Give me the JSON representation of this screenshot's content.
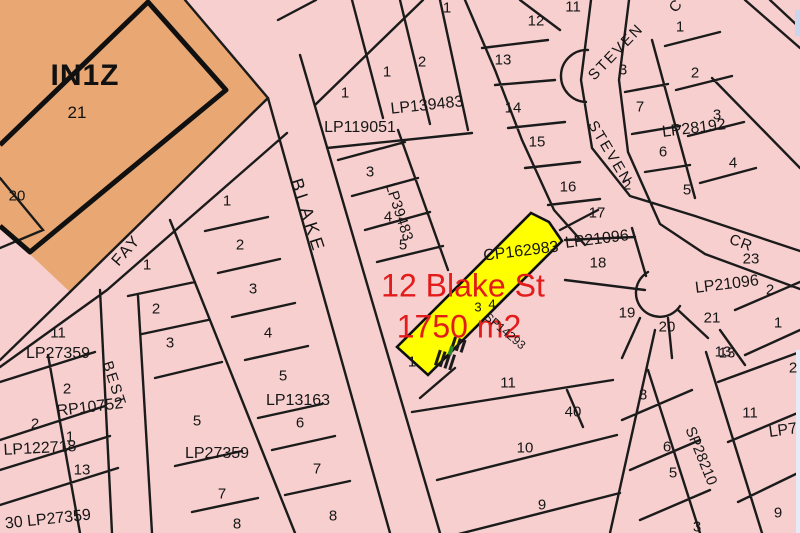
{
  "map": {
    "background": "#F7CFCF",
    "line_color": "#1b1b1b",
    "zone": {
      "code": "IN1Z",
      "lot_label": "21",
      "fill": "#E9A873"
    },
    "highlight_parcel": {
      "label_line1": "12 Blake St",
      "label_line2": "1750 m2",
      "fill": "#FFFF00",
      "label_color": "#e31b1b"
    },
    "street_labels": [
      {
        "t": "BLAKE",
        "x": 308,
        "y": 216,
        "r": 72,
        "s": 18,
        "ls": 4
      },
      {
        "t": "FAY",
        "x": 127,
        "y": 251,
        "r": -49,
        "s": 16,
        "ls": 2
      },
      {
        "t": "BEST",
        "x": 114,
        "y": 384,
        "r": 72,
        "s": 15,
        "ls": 2
      },
      {
        "t": "STEVEN",
        "x": 616,
        "y": 52,
        "r": -46,
        "s": 15,
        "ls": 2
      },
      {
        "t": "STEVEN",
        "x": 610,
        "y": 153,
        "r": 59,
        "s": 15,
        "ls": 2
      },
      {
        "t": "CR",
        "x": 741,
        "y": 243,
        "r": 20,
        "s": 15,
        "ls": 1
      },
      {
        "t": "C",
        "x": 676,
        "y": 6,
        "r": -50,
        "s": 15,
        "ls": 1
      }
    ],
    "plan_labels": [
      {
        "t": "LP119051",
        "x": 360,
        "y": 128,
        "r": 0
      },
      {
        "t": "LP139483",
        "x": 427,
        "y": 106,
        "r": -6
      },
      {
        "t": "LP39483",
        "x": 399,
        "y": 212,
        "r": 72,
        "s": 15
      },
      {
        "t": "LP28192",
        "x": 694,
        "y": 129,
        "r": -7
      },
      {
        "t": "CP162983",
        "x": 521,
        "y": 252,
        "r": -7
      },
      {
        "t": "LP21096",
        "x": 597,
        "y": 240,
        "r": -7
      },
      {
        "t": "LP21096",
        "x": 727,
        "y": 285,
        "r": -7
      },
      {
        "t": "LP27359",
        "x": 58,
        "y": 354,
        "r": 0
      },
      {
        "t": "RP10752",
        "x": 90,
        "y": 408,
        "r": -7
      },
      {
        "t": "LP122718",
        "x": 40,
        "y": 449,
        "r": -3
      },
      {
        "t": "LP13163",
        "x": 298,
        "y": 401,
        "r": 0
      },
      {
        "t": "LP27359",
        "x": 217,
        "y": 454,
        "r": 0
      },
      {
        "t": "30 LP27359",
        "x": 48,
        "y": 520,
        "r": -6
      },
      {
        "t": "SP28210",
        "x": 701,
        "y": 456,
        "r": 68,
        "s": 15
      },
      {
        "t": "SP14293",
        "x": 505,
        "y": 331,
        "r": 40,
        "s": 12
      },
      {
        "t": "LP7",
        "x": 783,
        "y": 431,
        "r": -8
      }
    ],
    "lot_numbers": [
      {
        "t": "20",
        "x": 17,
        "y": 196
      },
      {
        "t": "1",
        "x": 147,
        "y": 265
      },
      {
        "t": "2",
        "x": 156,
        "y": 309
      },
      {
        "t": "3",
        "x": 170,
        "y": 343
      },
      {
        "t": "1",
        "x": 227,
        "y": 201
      },
      {
        "t": "2",
        "x": 240,
        "y": 245
      },
      {
        "t": "3",
        "x": 253,
        "y": 289
      },
      {
        "t": "4",
        "x": 268,
        "y": 333
      },
      {
        "t": "5",
        "x": 283,
        "y": 376
      },
      {
        "t": "6",
        "x": 300,
        "y": 423
      },
      {
        "t": "7",
        "x": 317,
        "y": 469
      },
      {
        "t": "8",
        "x": 333,
        "y": 516
      },
      {
        "t": "5",
        "x": 197,
        "y": 421
      },
      {
        "t": "7",
        "x": 222,
        "y": 494
      },
      {
        "t": "8",
        "x": 237,
        "y": 524
      },
      {
        "t": "11",
        "x": 58,
        "y": 333
      },
      {
        "t": "2",
        "x": 67,
        "y": 389
      },
      {
        "t": "2",
        "x": 35,
        "y": 424
      },
      {
        "t": "1",
        "x": 70,
        "y": 437
      },
      {
        "t": "13",
        "x": 82,
        "y": 470
      },
      {
        "t": "1",
        "x": 345,
        "y": 93
      },
      {
        "t": "1",
        "x": 387,
        "y": 72
      },
      {
        "t": "2",
        "x": 422,
        "y": 62
      },
      {
        "t": "1",
        "x": 447,
        "y": 8
      },
      {
        "t": "13",
        "x": 503,
        "y": 60
      },
      {
        "t": "12",
        "x": 536,
        "y": 21
      },
      {
        "t": "11",
        "x": 573,
        "y": 7
      },
      {
        "t": "14",
        "x": 513,
        "y": 108
      },
      {
        "t": "15",
        "x": 537,
        "y": 142
      },
      {
        "t": "16",
        "x": 568,
        "y": 187
      },
      {
        "t": "17",
        "x": 597,
        "y": 213
      },
      {
        "t": "18",
        "x": 598,
        "y": 263
      },
      {
        "t": "3",
        "x": 370,
        "y": 172
      },
      {
        "t": "4",
        "x": 388,
        "y": 217
      },
      {
        "t": "5",
        "x": 403,
        "y": 245
      },
      {
        "t": "3",
        "x": 623,
        "y": 70
      },
      {
        "t": "7",
        "x": 640,
        "y": 107
      },
      {
        "t": "6",
        "x": 663,
        "y": 152
      },
      {
        "t": "1",
        "x": 680,
        "y": 27
      },
      {
        "t": "2",
        "x": 695,
        "y": 73
      },
      {
        "t": "3",
        "x": 717,
        "y": 115
      },
      {
        "t": "4",
        "x": 733,
        "y": 163
      },
      {
        "t": "5",
        "x": 687,
        "y": 190
      },
      {
        "t": "2",
        "x": 627,
        "y": 185
      },
      {
        "t": "23",
        "x": 751,
        "y": 259
      },
      {
        "t": "2",
        "x": 770,
        "y": 290
      },
      {
        "t": "1",
        "x": 778,
        "y": 323
      },
      {
        "t": "19",
        "x": 627,
        "y": 313
      },
      {
        "t": "20",
        "x": 667,
        "y": 327
      },
      {
        "t": "21",
        "x": 712,
        "y": 318
      },
      {
        "t": "13",
        "x": 723,
        "y": 352
      },
      {
        "t": "3",
        "x": 478,
        "y": 307,
        "s": 13
      },
      {
        "t": "4",
        "x": 492,
        "y": 304,
        "s": 13
      },
      {
        "t": "1",
        "x": 412,
        "y": 362
      },
      {
        "t": "11",
        "x": 508,
        "y": 383
      },
      {
        "t": "40",
        "x": 573,
        "y": 412
      },
      {
        "t": "10",
        "x": 525,
        "y": 448
      },
      {
        "t": "9",
        "x": 542,
        "y": 505
      },
      {
        "t": "13",
        "x": 727,
        "y": 353
      },
      {
        "t": "8",
        "x": 643,
        "y": 395
      },
      {
        "t": "11",
        "x": 750,
        "y": 413
      },
      {
        "t": "6",
        "x": 667,
        "y": 447
      },
      {
        "t": "5",
        "x": 673,
        "y": 473
      },
      {
        "t": "9",
        "x": 778,
        "y": 513
      },
      {
        "t": "3",
        "x": 697,
        "y": 527
      },
      {
        "t": "2",
        "x": 793,
        "y": 368
      }
    ]
  }
}
